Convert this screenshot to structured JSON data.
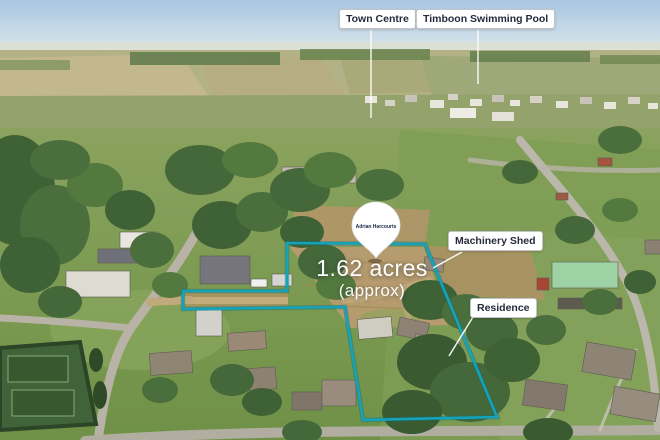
{
  "scene": {
    "description": "Aerial drone photograph of a 1.62 acre township property outlined in teal",
    "area_label": {
      "value": "1.62 acres",
      "qualifier": "(approx)"
    },
    "pin": {
      "logo_text": "Adrian Harcourts"
    },
    "callouts": [
      {
        "id": "town-centre",
        "label": "Town Centre"
      },
      {
        "id": "swimming-pool",
        "label": "Timboon Swimming Pool"
      },
      {
        "id": "machinery-shed",
        "label": "Machinery Shed"
      },
      {
        "id": "residence",
        "label": "Residence"
      }
    ],
    "colors": {
      "boundary": "#14a3b8",
      "boundary_shadow": "#0b6b7d",
      "label_bg": "#ffffff",
      "label_text": "#262b3c",
      "leader_line": "#ffffff",
      "area_text": "#ffffff"
    }
  }
}
